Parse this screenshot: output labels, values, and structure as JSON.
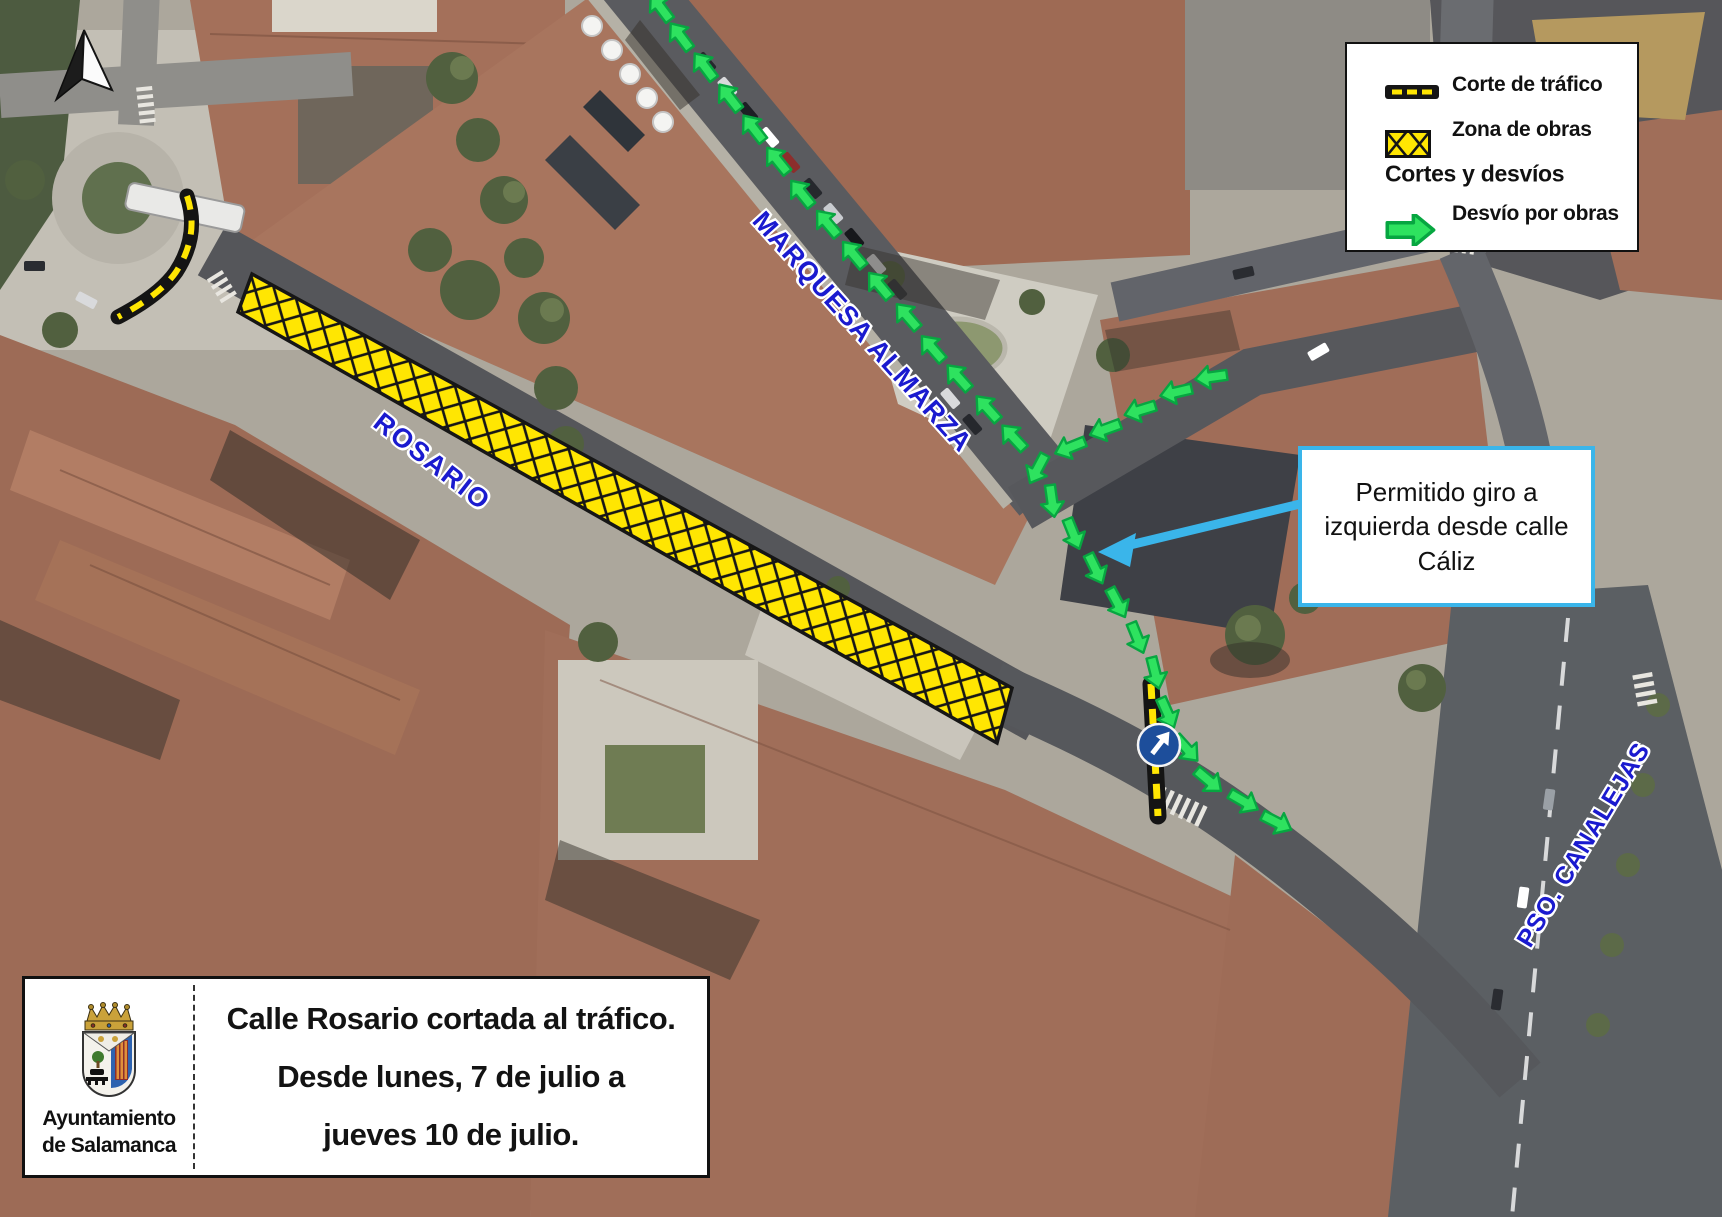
{
  "legend": {
    "items": [
      {
        "icon": "traffic-cut-line-icon",
        "label": "Corte de tráfico"
      },
      {
        "icon": "works-zone-icon",
        "label": "Zona de obras"
      },
      {
        "icon": null,
        "label": "Cortes y desvíos"
      },
      {
        "icon": "detour-arrow-icon",
        "label": "Desvío por obras"
      }
    ]
  },
  "callout": {
    "text": "Permitido giro a izquierda desde calle Cáliz"
  },
  "info_panel": {
    "organization": {
      "line1": "Ayuntamiento",
      "line2": "de Salamanca"
    },
    "message": {
      "line1": "Calle Rosario cortada al tráfico.",
      "line2": "Desde lunes, 7 de julio a",
      "line3": "jueves 10 de julio."
    }
  },
  "street_labels": {
    "rosario": "ROSARIO",
    "marquesa_almarza": "MARQUESA ALMARZA",
    "pso_canalejas": "PSO. CANALEJAS"
  },
  "colors": {
    "works_zone_yellow": "#ffe602",
    "detour_green_fill": "#2ee25f",
    "detour_green_outline": "#07a641",
    "street_label_blue": "#1a1acf",
    "callout_border_blue": "#3ab5ea",
    "mandatory_sign_blue": "#1d4e9b"
  },
  "map_annotations": {
    "mandatory_direction_sign": {
      "x": 1159,
      "y": 745
    },
    "detour_arrows": [
      {
        "x": 661,
        "y": 8,
        "r": 233
      },
      {
        "x": 681,
        "y": 37,
        "r": 233
      },
      {
        "x": 705,
        "y": 67,
        "r": 233
      },
      {
        "x": 730,
        "y": 98,
        "r": 232
      },
      {
        "x": 754,
        "y": 129,
        "r": 232
      },
      {
        "x": 778,
        "y": 161,
        "r": 231
      },
      {
        "x": 802,
        "y": 194,
        "r": 231
      },
      {
        "x": 828,
        "y": 224,
        "r": 230
      },
      {
        "x": 854,
        "y": 255,
        "r": 230
      },
      {
        "x": 880,
        "y": 286,
        "r": 230
      },
      {
        "x": 908,
        "y": 317,
        "r": 229
      },
      {
        "x": 933,
        "y": 349,
        "r": 229
      },
      {
        "x": 959,
        "y": 378,
        "r": 228
      },
      {
        "x": 988,
        "y": 409,
        "r": 228
      },
      {
        "x": 1014,
        "y": 438,
        "r": 227
      },
      {
        "x": 1212,
        "y": 377,
        "r": 172
      },
      {
        "x": 1177,
        "y": 392,
        "r": 167
      },
      {
        "x": 1141,
        "y": 410,
        "r": 163
      },
      {
        "x": 1106,
        "y": 429,
        "r": 160
      },
      {
        "x": 1071,
        "y": 447,
        "r": 158
      },
      {
        "x": 1038,
        "y": 468,
        "r": 118
      },
      {
        "x": 1052,
        "y": 500,
        "r": 82
      },
      {
        "x": 1073,
        "y": 533,
        "r": 68
      },
      {
        "x": 1095,
        "y": 568,
        "r": 64
      },
      {
        "x": 1117,
        "y": 602,
        "r": 62
      },
      {
        "x": 1137,
        "y": 637,
        "r": 68
      },
      {
        "x": 1155,
        "y": 672,
        "r": 76
      },
      {
        "x": 1167,
        "y": 712,
        "r": 66
      },
      {
        "x": 1186,
        "y": 748,
        "r": 48
      },
      {
        "x": 1208,
        "y": 780,
        "r": 40
      },
      {
        "x": 1243,
        "y": 801,
        "r": 30
      },
      {
        "x": 1276,
        "y": 822,
        "r": 27
      }
    ]
  }
}
